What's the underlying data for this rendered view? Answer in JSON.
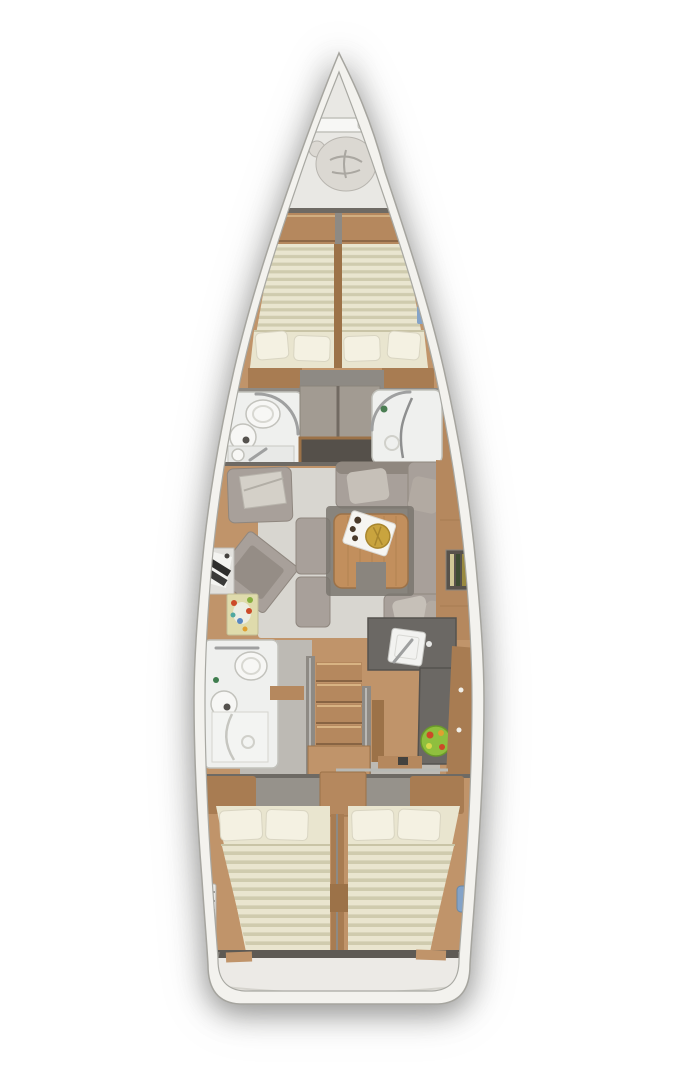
{
  "meta": {
    "type": "yacht-interior-floor-plan",
    "view": "top-down deck plan, bow at top, stern at bottom",
    "text_visible": "none"
  },
  "colors": {
    "hull": "#f3f2ee",
    "hullLine": "#a6a59f",
    "wallGray": "#c2bfb9",
    "wallDark": "#8e8a84",
    "bulkhead": "#6e6a64",
    "wood": "#b5885e",
    "woodDark": "#9c7248",
    "woodFloor": "#c0946a",
    "woodCab": "#a87c52",
    "matBase": "#e9e5cf",
    "matStripe": "#cfcbae",
    "pillow": "#f4f1e2",
    "pillowLine": "#d9d5c2",
    "carpet": "#d8d6d0",
    "sofa": "#a8a09a",
    "sofaDark": "#8f877f",
    "sofaLight": "#c6c0b8",
    "counter": "#6b6864",
    "counterDark": "#55524e",
    "white": "#f7f7f5",
    "fixtureLine": "#c2c2bc",
    "chrome": "#9fa0a0",
    "bathFloor": "#eff0ee",
    "floorGray": "#bdbab4",
    "tableWood": "#c28f5d",
    "gold": "#c9a43e",
    "goldDark": "#a8862e",
    "fruitGreen": "#8fbf3e",
    "fruitRed": "#cc4a28",
    "rugBase": "#dfdbac",
    "blue": "#84a3c8",
    "bowFloor": "#e9e8e4",
    "sternFloor": "#eceae6"
  },
  "rooms": [
    {
      "name": "anchor-locker",
      "features": [
        "windlass",
        "chain-bag",
        "bow-fitting"
      ]
    },
    {
      "name": "forward-cabin",
      "features": [
        "double-v-berth",
        "striped-mattresses",
        "four-pillows",
        "side-shelves"
      ]
    },
    {
      "name": "forward-head-port",
      "features": [
        "toilet",
        "round-sink",
        "curved-door"
      ]
    },
    {
      "name": "forward-shower-starboard",
      "features": [
        "shower-tray",
        "drain",
        "curved-door"
      ]
    },
    {
      "name": "wardrobe-midship",
      "features": [
        "lockers",
        "open-cubby"
      ]
    },
    {
      "name": "salon",
      "features": [
        "u-shaped-sofa",
        "folding-table",
        "serving-tray",
        "armchair",
        "bench",
        "nav-desk",
        "chart-rug",
        "bottle-rack-sideboard"
      ]
    },
    {
      "name": "aft-head-port",
      "features": [
        "toilet",
        "round-sink",
        "shower"
      ]
    },
    {
      "name": "galley-starboard",
      "features": [
        "sink",
        "faucet",
        "worktop",
        "fruit-bowl",
        "cabinets"
      ]
    },
    {
      "name": "companionway",
      "features": [
        "wooden-steps",
        "handrails",
        "landing"
      ]
    },
    {
      "name": "aft-cabin-port",
      "features": [
        "double-berth",
        "striped-duvet",
        "two-pillows"
      ]
    },
    {
      "name": "aft-cabin-starboard",
      "features": [
        "double-berth",
        "striped-duvet",
        "two-pillows"
      ]
    },
    {
      "name": "stern-transom",
      "features": [
        "swim-platform-edge"
      ]
    }
  ],
  "icons": [
    "windlass-icon",
    "toilet-icon",
    "sink-icon",
    "shower-drain-icon",
    "faucet-icon",
    "laptop-icon",
    "chart-rug-icon",
    "serving-tray-icon",
    "fruit-bowl-icon",
    "bottle-rack-icon",
    "ladder-icon",
    "fender-icon",
    "hatch-icon"
  ]
}
